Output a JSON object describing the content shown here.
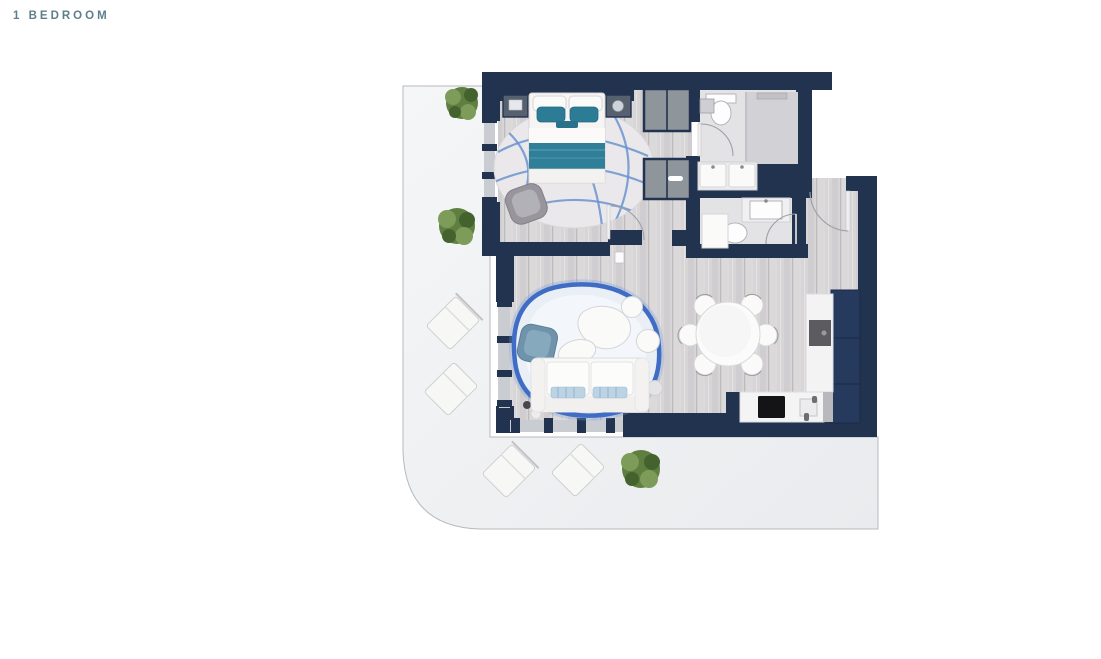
{
  "page": {
    "title": "1 BEDROOM"
  },
  "floorplan": {
    "kind": "top-down 3D rendered apartment floor plan",
    "unit_type": "1 Bedroom",
    "rooms": [
      "bedroom",
      "bathroom with shower",
      "guest bathroom",
      "hallway",
      "living room",
      "dining area",
      "kitchen",
      "entry",
      "wrap-around balcony terrace"
    ],
    "furniture": [
      "double bed with teal runner and pillows",
      "two nightstands",
      "round wavy-pattern rug",
      "gray armchair",
      "two wardrobes",
      "toilet",
      "walk-in shower",
      "double vanity with two sinks",
      "washer cabinet",
      "white sofa with blue cushions",
      "organic coffee table",
      "blue armchair",
      "poufs",
      "blue-bordered area rug",
      "round dining table with six chairs",
      "kitchen counters with cooktop and sink",
      "tall navy kitchen units",
      "four balcony lounge chairs",
      "three potted plants"
    ]
  },
  "colors": {
    "page_bg": "#ffffff",
    "title_text": "#5d7f8c",
    "wall": "#22334f",
    "wall_light": "#263a5e",
    "window": "#c9ccd1",
    "wood_floor": "#d8d5d7",
    "bath_floor": "#e3e2e4",
    "shower_floor": "#d2d1d5",
    "balcony_start": "#f4f5f6",
    "balcony_end": "#e9ebee",
    "accent_teal": "#2f7f98",
    "rug_blue": "#3f6dc6",
    "rug_blue_soft": "#6b93cf",
    "rug_fill": "#eaeff6",
    "furniture_white": "#fafaf9",
    "furniture_stroke": "#d5d4d7",
    "gray_furniture": "#a3a1a8",
    "cooktop_black": "#141417",
    "appliance_gray": "#5c5c60",
    "plant_dark": "#44622e",
    "plant_mid": "#5f7f40",
    "plant_light": "#7d9b59"
  }
}
